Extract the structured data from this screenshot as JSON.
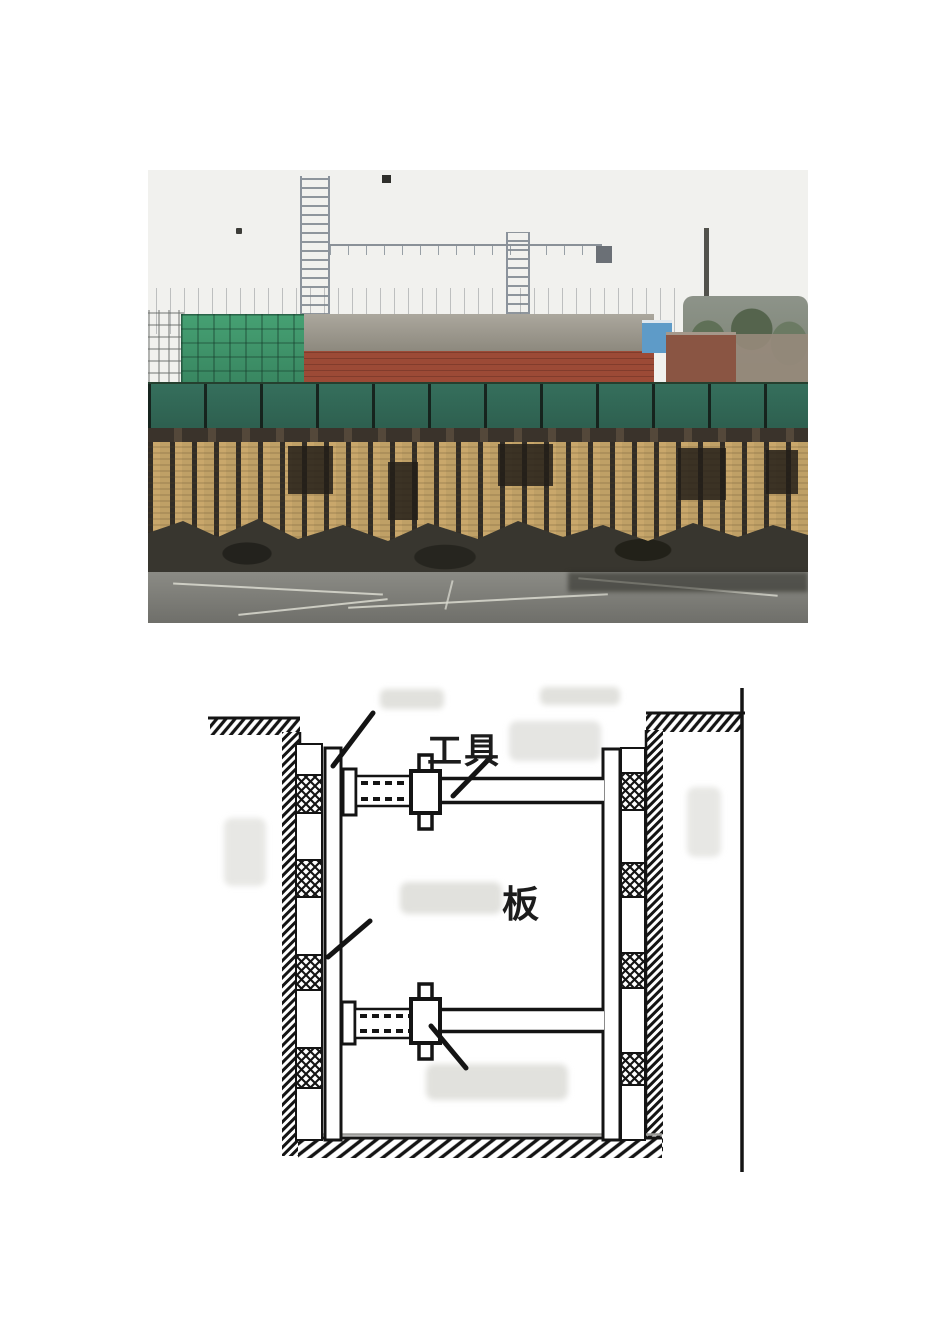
{
  "page": {
    "type": "document-page",
    "background": "#ffffff"
  },
  "photo": {
    "alt": "construction-site-timber-shoring-wall-photo",
    "colors": {
      "sky": "#f1f1ee",
      "safety_net_green": "#356f5c",
      "brick_red": "#9c4a36",
      "roof_gray": "#9b978c",
      "scaffold_green": "#46a173",
      "blue_shed": "#5e9bc8",
      "timber_tan": "#c9a76b",
      "soil_dark": "#38362f",
      "ground_gray": "#82827d"
    }
  },
  "diagram": {
    "alt": "trench-shoring-cross-section",
    "labels": {
      "tool": "工具",
      "board": "板"
    },
    "colors": {
      "ink": "#1c1c1c",
      "smudge": "#e1e1dd",
      "shadow_gray": "#9a9a97"
    }
  }
}
